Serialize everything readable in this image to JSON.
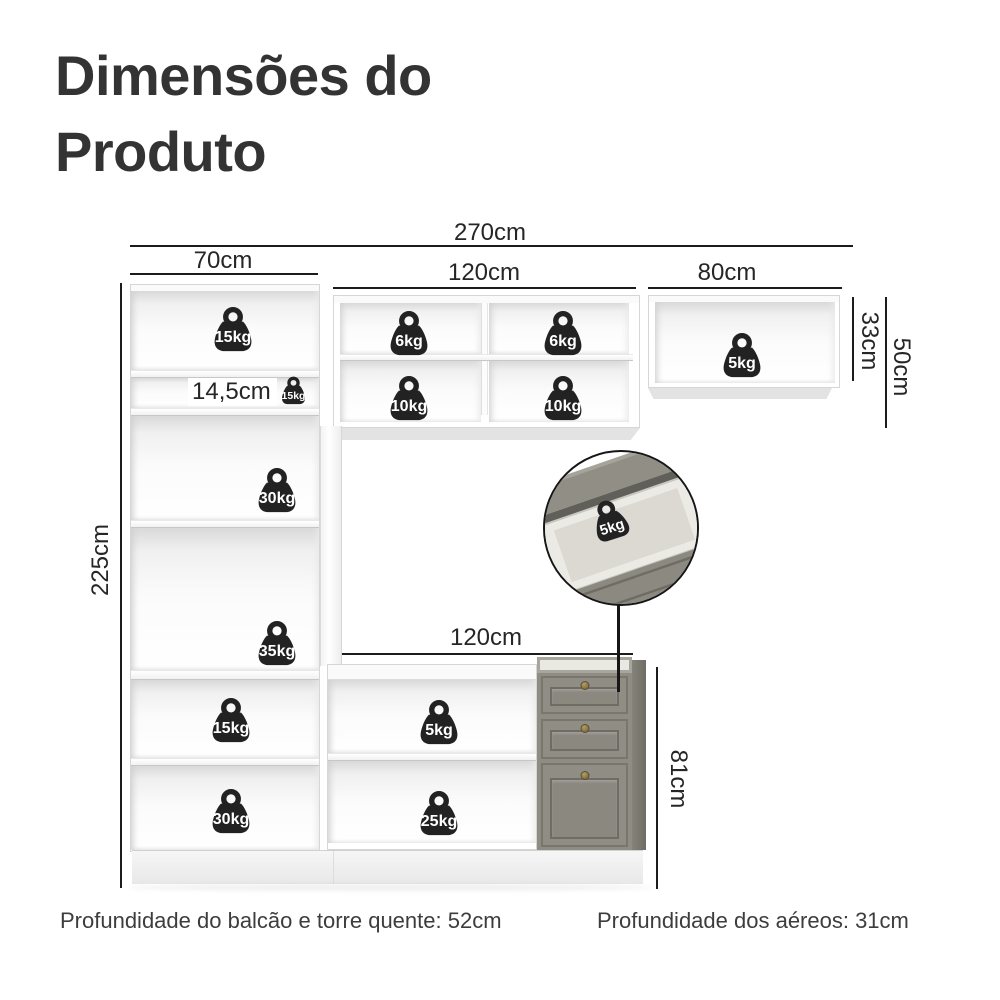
{
  "title": {
    "line1": "Dimensões do",
    "line2": "Produto"
  },
  "dimensions": {
    "total_width": "270cm",
    "tower_width": "70cm",
    "upper_middle_width": "120cm",
    "upper_right_width": "80cm",
    "upper_right_height": "33cm",
    "upper_middle_height": "50cm",
    "tower_height": "225cm",
    "tower_small_shelf_height": "14,5cm",
    "tower_upper_space_height": "37,25cm",
    "tower_lower_space_height": "54,25cm",
    "base_width": "120cm",
    "base_height": "81cm"
  },
  "weights": {
    "tower_top": "15kg",
    "tower_small_shelf": "15kg",
    "upper_middle": [
      "6kg",
      "6kg",
      "10kg",
      "10kg"
    ],
    "upper_right": "5kg",
    "tower_space_upper": "30kg",
    "tower_space_lower": "35kg",
    "tower_bottom_upper": "15kg",
    "tower_bottom_lower": "30kg",
    "base_shelf_upper": "5kg",
    "base_shelf_lower": "25kg",
    "drawer_callout": "5kg"
  },
  "footer": {
    "depth_base": "Profundidade do balcão e torre quente: 52cm",
    "depth_upper": "Profundidade dos aéreos: 31cm"
  },
  "colors": {
    "title_text": "#333333",
    "dimension_lines": "#1c1c1c",
    "weight_badge": "#222222",
    "weight_text": "#ffffff",
    "cabinet_white": "#ffffff",
    "drawer_front": "#8e8b82",
    "drawer_side": "#7b786f",
    "knob_brass": "#8d7b4e",
    "plinth": "#ededed"
  }
}
